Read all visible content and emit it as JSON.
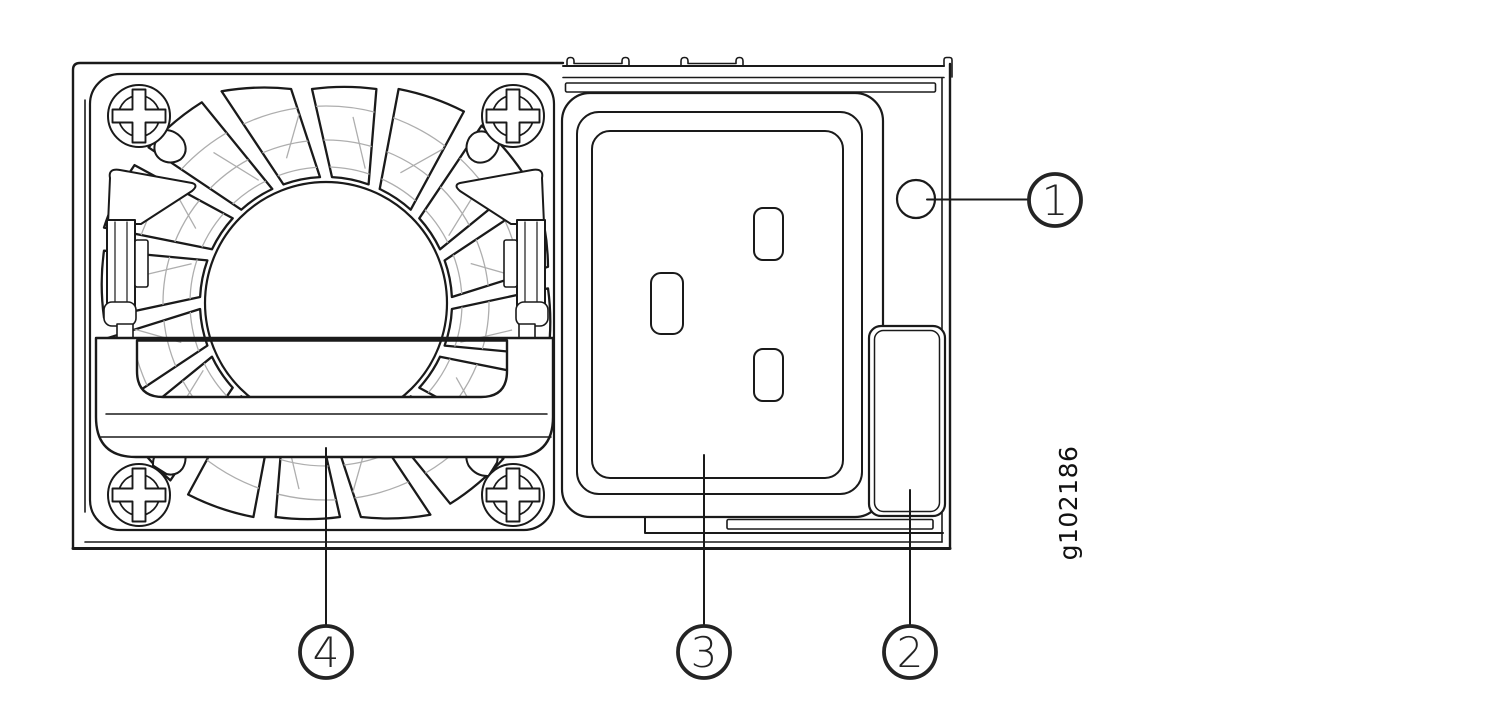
{
  "figure_id": "g102186",
  "callouts": [
    {
      "number": "1"
    },
    {
      "number": "2"
    },
    {
      "number": "3"
    },
    {
      "number": "4"
    }
  ],
  "colors": {
    "line": "#1a1a1a",
    "led_fill": "#c6c7c8",
    "detail_gray": "#aeaeae",
    "callout_text": "#242424",
    "background": "#ffffff"
  }
}
